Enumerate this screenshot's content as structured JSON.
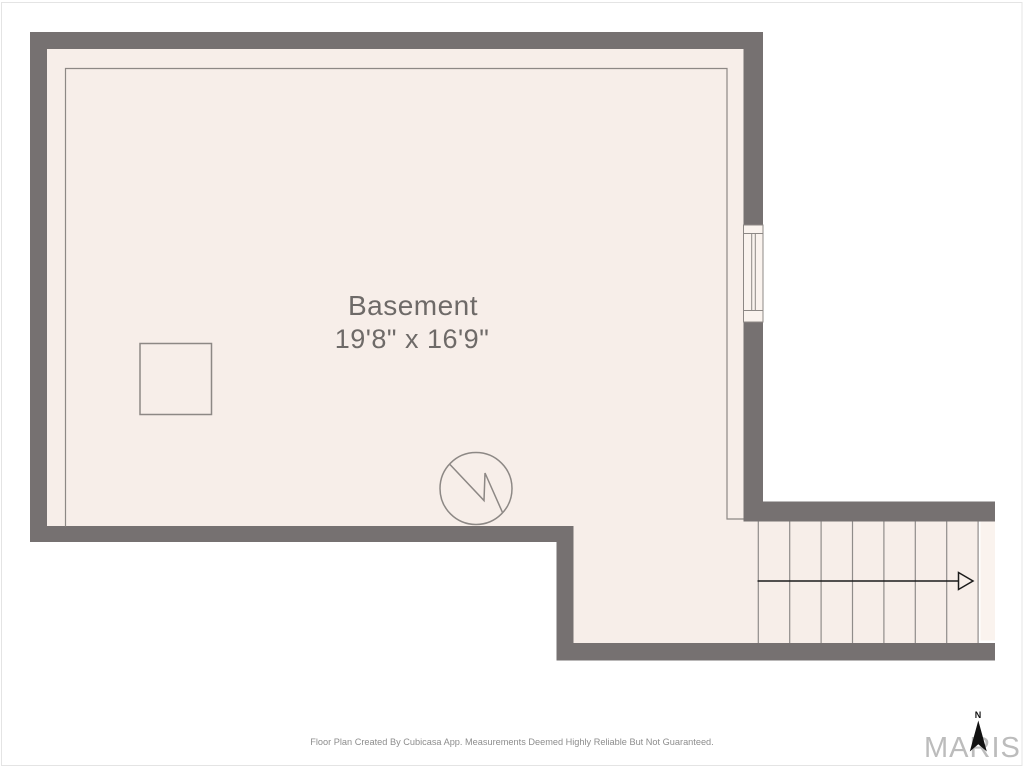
{
  "floor_plan": {
    "room": {
      "name": "Basement",
      "dimensions": "19'8\" x 16'9\""
    },
    "stairs": {
      "tread_line_count": 8,
      "direction": "right"
    },
    "symbols": [
      "window",
      "square-fixture",
      "water-heater",
      "staircase-arrow"
    ]
  },
  "compass": {
    "north_label": "N"
  },
  "branding": {
    "watermark": "MARIS"
  },
  "footer": {
    "disclaimer": "Floor Plan Created By Cubicasa App. Measurements Deemed Highly Reliable But Not Guaranteed."
  },
  "colors": {
    "wall": "#767171",
    "floor": "#f7eee9",
    "floor-light": "#faf3ee",
    "outline": "#8d8885",
    "tread": "#908c8a",
    "arrow": "#1c1c1c",
    "label": "#6e6a68",
    "footer": "#8d8d8d",
    "watermark": "#bcbcbc",
    "page-border": "#e4e4e4"
  }
}
